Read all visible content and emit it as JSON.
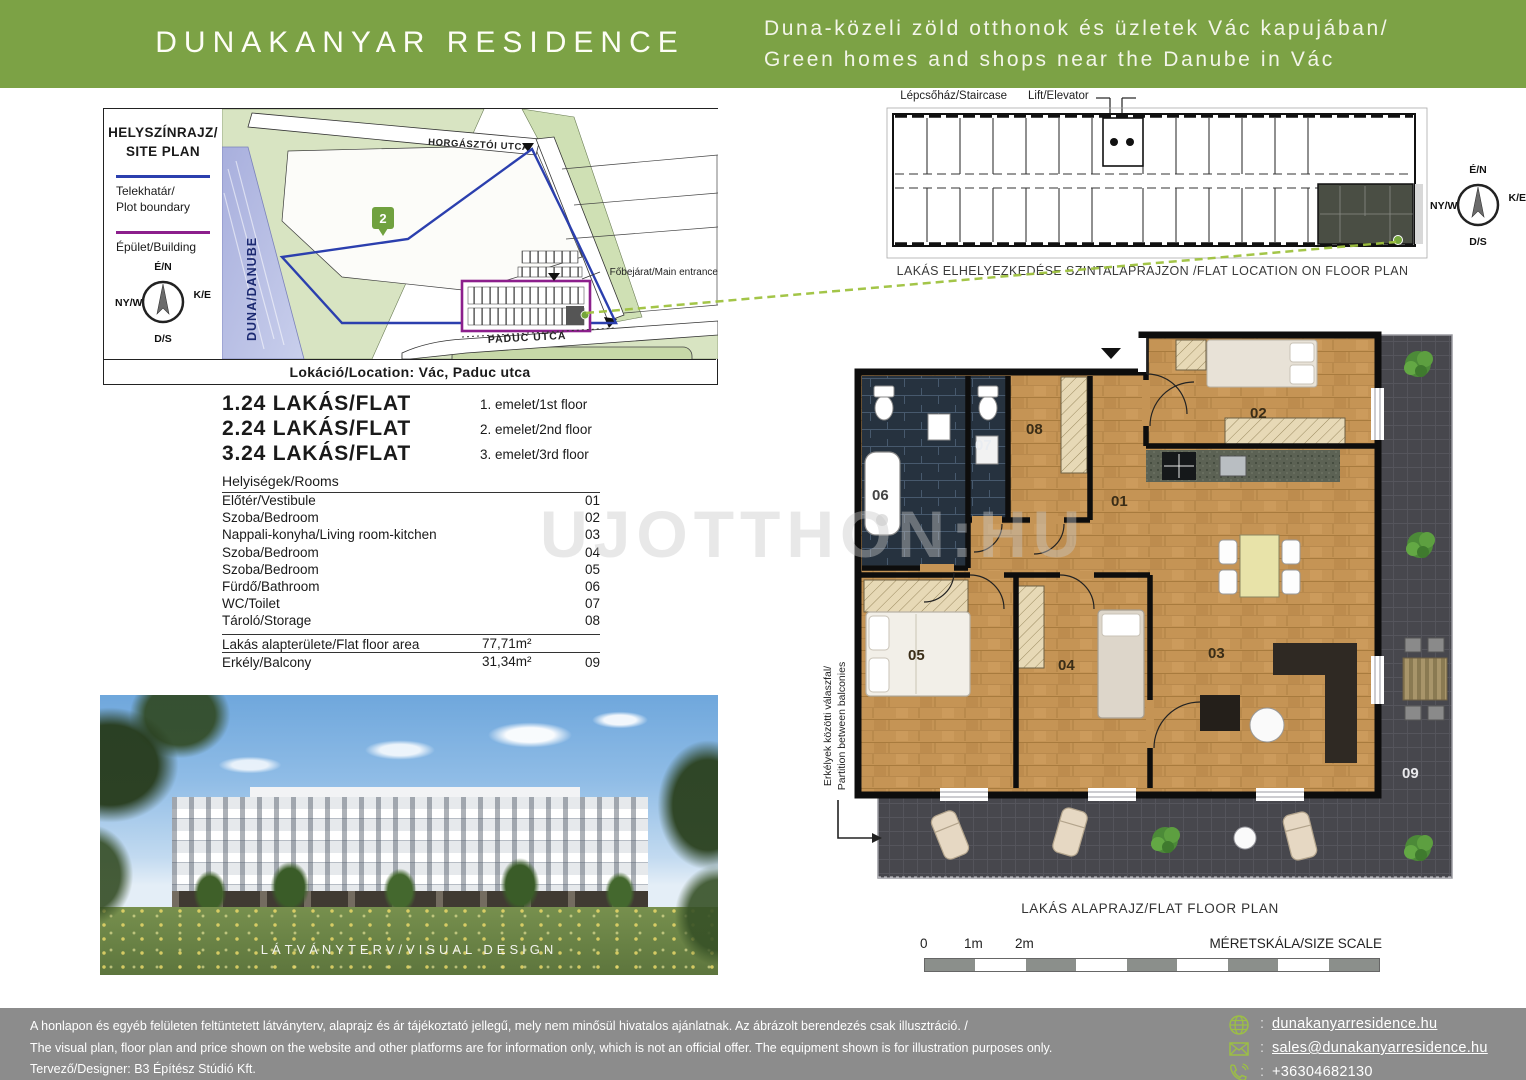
{
  "header": {
    "title": "DUNAKANYAR RESIDENCE",
    "tagline_hu": "Duna-közeli zöld otthonok és üzletek Vác kapujában/",
    "tagline_en": "Green homes and shops near the Danube in Vác"
  },
  "site_plan": {
    "heading1": "HELYSZÍNRAJZ/",
    "heading2": "SITE PLAN",
    "legend_plot1": "Telekhatár/",
    "legend_plot2": "Plot boundary",
    "legend_building": "Épület/Building",
    "street_top": "HORGÁSZTÓI UTCA",
    "street_bottom": "PADUC UTCA",
    "river": "DUNA/DANUBE",
    "route_badge": "2",
    "entrance": "Főbejárat/Main entrance",
    "location": "Lokáció/Location: Vác, Paduc utca"
  },
  "compass": {
    "n": "É/N",
    "e": "K/E",
    "w": "NY/W",
    "s": "D/S"
  },
  "flats": [
    {
      "name": "1.24 LAKÁS/FLAT",
      "floor": "1. emelet/1st floor"
    },
    {
      "name": "2.24 LAKÁS/FLAT",
      "floor": "2. emelet/2nd floor"
    },
    {
      "name": "3.24 LAKÁS/FLAT",
      "floor": "3. emelet/3rd floor"
    }
  ],
  "rooms": {
    "heading": "Helyiségek/Rooms",
    "items": [
      {
        "name": "Előtér/Vestibule",
        "num": "01"
      },
      {
        "name": "Szoba/Bedroom",
        "num": "02"
      },
      {
        "name": "Nappali-konyha/Living room-kitchen",
        "num": "03"
      },
      {
        "name": "Szoba/Bedroom",
        "num": "04"
      },
      {
        "name": "Szoba/Bedroom",
        "num": "05"
      },
      {
        "name": "Fürdő/Bathroom",
        "num": "06"
      },
      {
        "name": "WC/Toilet",
        "num": "07"
      },
      {
        "name": "Tároló/Storage",
        "num": "08"
      }
    ],
    "area_label": "Lakás alapterülete/Flat floor area",
    "area_value": "77,71m²",
    "balcony_label": "Erkély/Balcony",
    "balcony_value": "31,34m²",
    "balcony_num": "09"
  },
  "visual": {
    "caption": "LÁTVÁNYTERV/VISUAL DESIGN"
  },
  "mini_plan": {
    "staircase": "Lépcsőház/Staircase",
    "lift": "Lift/Elevator",
    "caption": "LAKÁS ELHELYEZKEDÉSE SZINTALAPRAJZON /FLAT LOCATION ON FLOOR PLAN"
  },
  "floor_plan": {
    "caption": "LAKÁS ALAPRAJZ/FLAT FLOOR PLAN",
    "partition1": "Erkélyek közötti válaszfal/",
    "partition2": "Partition between balconies",
    "labels": {
      "r01": "01",
      "r02": "02",
      "r03": "03",
      "r04": "04",
      "r05": "05",
      "r06": "06",
      "r07": "07",
      "r08": "08",
      "r09": "09"
    }
  },
  "scale_bar": {
    "t0": "0",
    "t1": "1m",
    "t2": "2m",
    "label": "MÉRETSKÁLA/SIZE SCALE"
  },
  "watermark": "UJOTTHON:HU",
  "footer": {
    "line_hu": "A honlapon és egyéb felületen feltüntetett látványterv, alaprajz és ár tájékoztató jellegű, mely nem minősül hivatalos ajánlatnak. Az ábrázolt berendezés csak illusztráció. /",
    "line_en": "The visual plan, floor plan and price shown on the website and other platforms are for information only, which is not an official offer. The equipment shown is for illustration purposes only.",
    "designer": "Tervező/Designer: B3 Építész Stúdió Kft.",
    "sep": ":",
    "website": "dunakanyarresidence.hu",
    "email": "sales@dunakanyarresidence.hu",
    "phone": "+36304682130"
  },
  "colors": {
    "brand_green": "#7CA245",
    "footer_gray": "#8C8C8C",
    "link_green": "#9CBF45",
    "plot_blue": "#2B3FAE",
    "building_purple": "#8C1F8C"
  }
}
